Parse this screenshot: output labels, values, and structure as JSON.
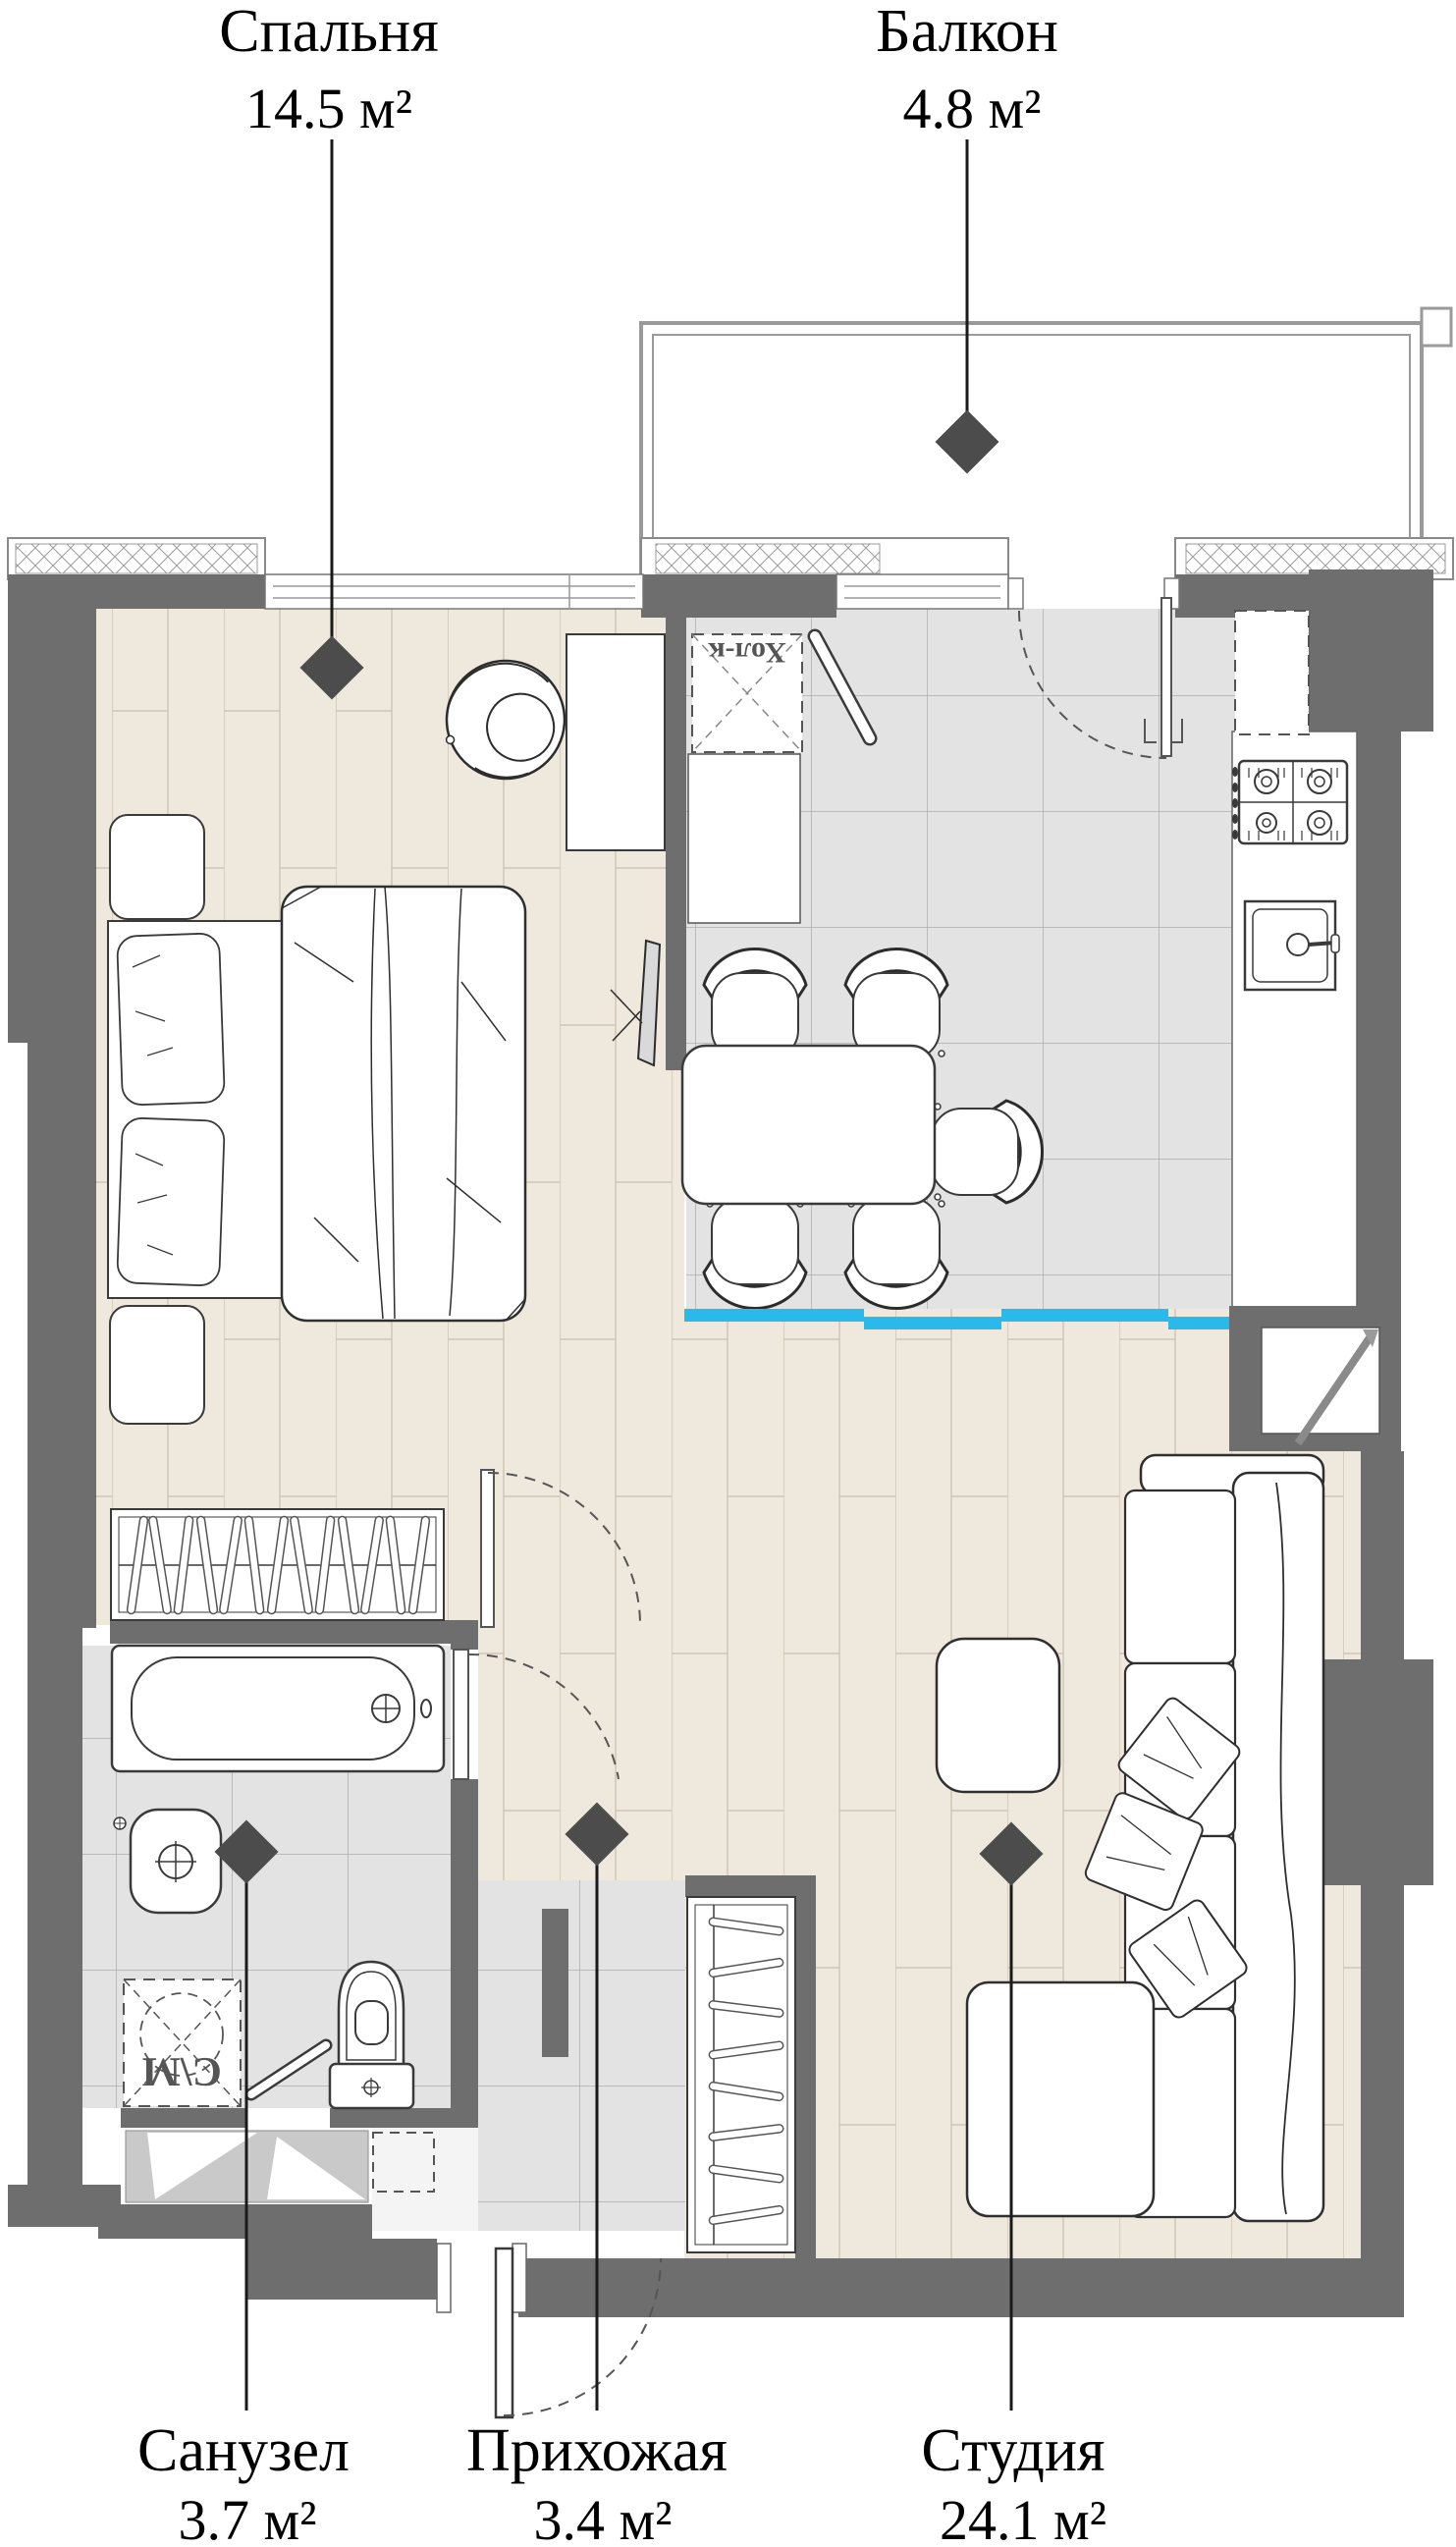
{
  "callouts": {
    "bedroom": {
      "name": "Спальня",
      "area": "14.5 м²"
    },
    "balcony": {
      "name": "Балкон",
      "area": "4.8 м²"
    },
    "bathroom": {
      "name": "Санузел",
      "area": "3.7 м²"
    },
    "hallway": {
      "name": "Прихожая",
      "area": "3.4 м²"
    },
    "studio": {
      "name": "Студия",
      "area": "24.1 м²"
    }
  },
  "fixtures": {
    "fridge_label": "Хол-к",
    "washer_label": "С\\М"
  },
  "icons": {
    "callout_marker": "diamond-marker-icon"
  },
  "colors": {
    "wall_gray": "#6E6E6E",
    "wood_floor": "#EFE8DC",
    "tile_floor": "#E3E3E3",
    "accent_blue": "#29B9EA",
    "balcony_outline": "#9A9A9A",
    "furniture_outline": "#3A3A3A",
    "callout_line": "#1A1A1A"
  }
}
